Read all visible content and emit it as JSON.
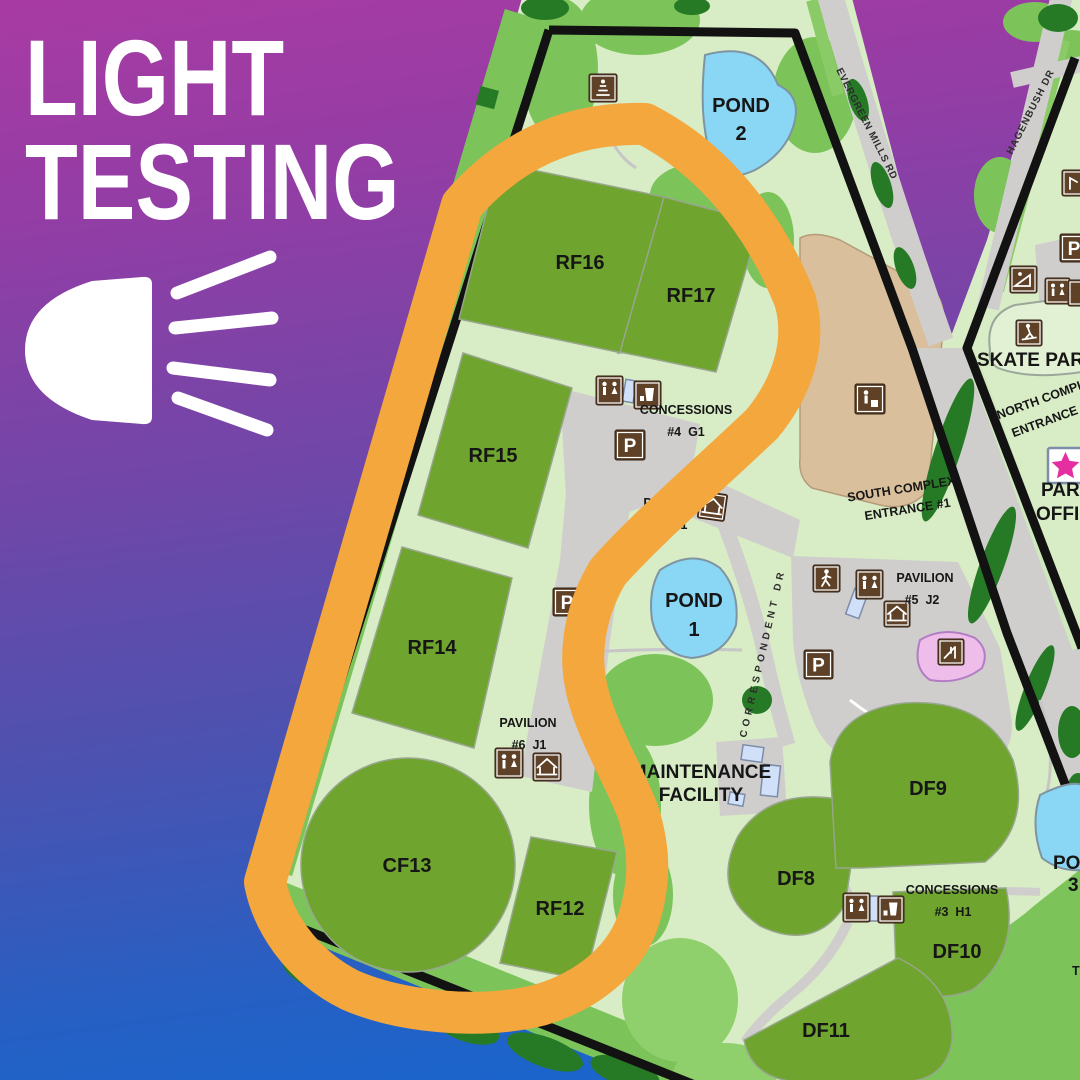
{
  "poster": {
    "title_line1": "LIGHT",
    "title_line2": "TESTING",
    "icon": "headlight-icon"
  },
  "map": {
    "fields": {
      "rf16": "RF16",
      "rf17": "RF17",
      "rf15": "RF15",
      "rf14": "RF14",
      "cf13": "CF13",
      "rf12": "RF12",
      "df8": "DF8",
      "df9": "DF9",
      "df10": "DF10",
      "df11": "DF11"
    },
    "ponds": {
      "pond1_name": "POND",
      "pond1_num": "1",
      "pond2_name": "POND",
      "pond2_num": "2",
      "pond3_name": "POND",
      "pond3_num": "3"
    },
    "roads": {
      "evergreen": "EVERGREEN MILLS RD",
      "hagenbush": "HAGENBUSH DR",
      "correspondent": "CORRESPONDENT DR"
    },
    "entrances": {
      "south_line1": "SOUTH COMPLEX",
      "south_line2": "ENTRANCE #1",
      "north_line1": "NORTH COMPLEX",
      "north_line2": "ENTRANCE #"
    },
    "amenities": {
      "concessions4_line1": "CONCESSIONS",
      "concessions4_line2": "#4  G1",
      "pavilion7_line1": "PAVILION",
      "pavilion7_line2": "#7  K1",
      "pavilion5_line1": "PAVILION",
      "pavilion5_line2": "#5  J2",
      "pavilion6_line1": "PAVILION",
      "pavilion6_line2": "#6  J1",
      "concessions3_line1": "CONCESSIONS",
      "concessions3_line2": "#3  H1"
    },
    "places": {
      "skate_park": "SKATE PARK",
      "park_office_line1": "PARK",
      "park_office_line2": "OFFICE",
      "maintenance_line1": "MAINTENANCE",
      "maintenance_line2": "FACILITY",
      "trail_partial": "T"
    },
    "icon_glyphs": {
      "parking": "P"
    },
    "colors": {
      "highlight_orange": "#f3a73d",
      "field_green": "#6fa42f",
      "pond_blue": "#8ad6f5",
      "icon_brown": "#5e4127",
      "map_base": "#d8ecc6",
      "gradient_top": "#a83ba3",
      "gradient_bottom": "#1467d0"
    }
  }
}
